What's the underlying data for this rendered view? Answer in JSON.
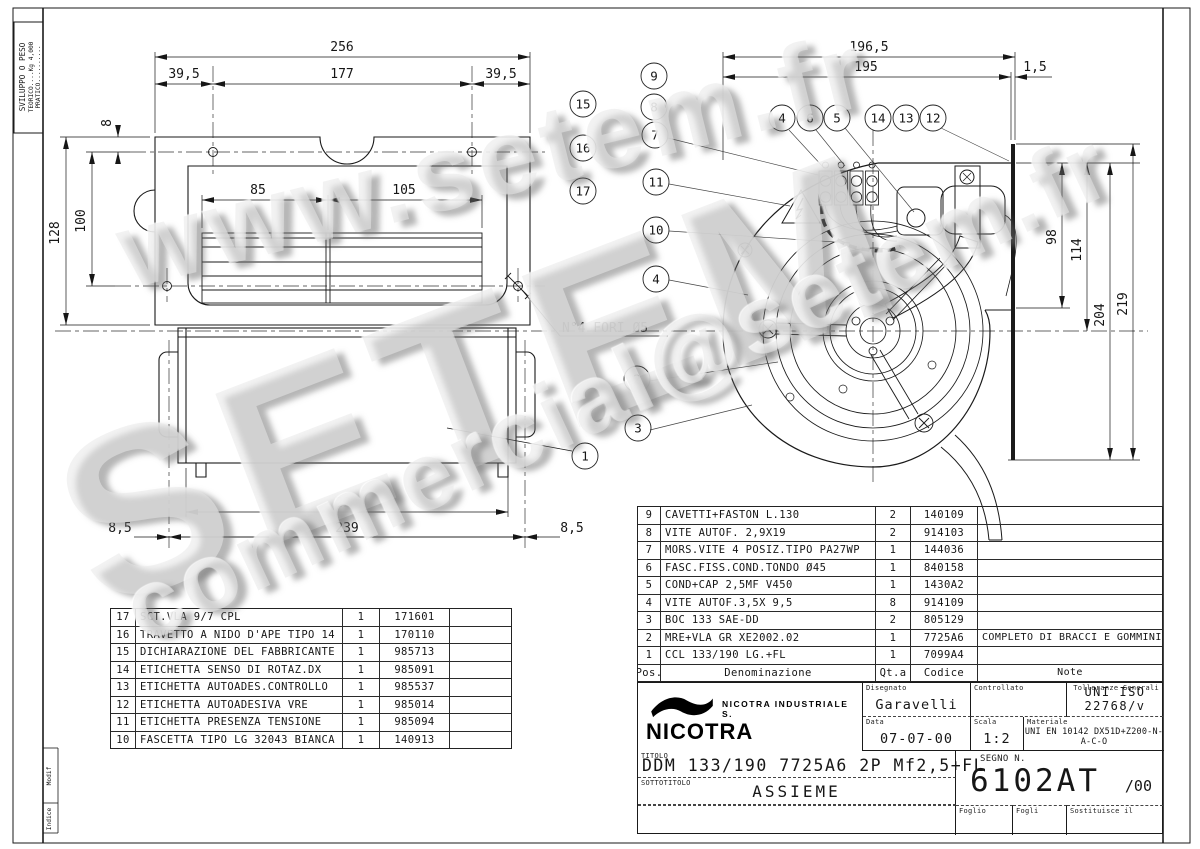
{
  "watermarks": {
    "line1": "www.setem.fr",
    "line2": "SETEM",
    "line3": "commercial@setem.fr"
  },
  "margins": {
    "weight_box": {
      "title": "SVILUPPO O PESO",
      "teorico": "TEORICO....Kg 4,000",
      "pratico": "PRATICO.........."
    },
    "rev_modif": "Modif",
    "rev_indice": "Indice"
  },
  "top_view": {
    "dim_256": "256",
    "dim_39_5_l": "39,5",
    "dim_177": "177",
    "dim_39_5_r": "39,5",
    "dim_8": "8",
    "dim_128": "128",
    "dim_100": "100",
    "dim_85": "85",
    "dim_105": "105",
    "note_holes": "N°4 FORI Ø5"
  },
  "front_view": {
    "dim_224": "224",
    "dim_239": "239",
    "dim_8_5_l": "8,5",
    "dim_8_5_r": "8,5",
    "balloon_1": "1"
  },
  "fan_view": {
    "dim_196_5": "196,5",
    "dim_195": "195",
    "dim_1_5": "1,5",
    "dim_98": "98",
    "dim_114": "114",
    "dim_204": "204",
    "dim_219": "219"
  },
  "balloons": {
    "stack": [
      "15",
      "16",
      "17"
    ],
    "fan_left": [
      "9",
      "8",
      "7",
      "11",
      "10",
      "4",
      "2",
      "3"
    ],
    "fan_top": [
      "4",
      "6",
      "5",
      "14",
      "13",
      "12"
    ]
  },
  "parts_left": {
    "rows": [
      {
        "pos": "17",
        "desc": "SCT.VLA 9/7 CPL",
        "qty": "1",
        "code": "171601"
      },
      {
        "pos": "16",
        "desc": "TRAVETTO A NIDO D'APE TIPO 14",
        "qty": "1",
        "code": "170110"
      },
      {
        "pos": "15",
        "desc": "DICHIARAZIONE DEL FABBRICANTE",
        "qty": "1",
        "code": "985713"
      },
      {
        "pos": "14",
        "desc": "ETICHETTA SENSO DI ROTAZ.DX",
        "qty": "1",
        "code": "985091"
      },
      {
        "pos": "13",
        "desc": "ETICHETTA AUTOADES.CONTROLLO",
        "qty": "1",
        "code": "985537"
      },
      {
        "pos": "12",
        "desc": "ETICHETTA AUTOADESIVA VRE",
        "qty": "1",
        "code": "985014"
      },
      {
        "pos": "11",
        "desc": "ETICHETTA PRESENZA TENSIONE",
        "qty": "1",
        "code": "985094"
      },
      {
        "pos": "10",
        "desc": "FASCETTA TIPO LG 32043 BIANCA",
        "qty": "1",
        "code": "140913"
      }
    ]
  },
  "parts_right": {
    "header": {
      "pos": "Pos.",
      "desc": "Denominazione",
      "qty": "Qt.a",
      "code": "Codice",
      "note": "Note"
    },
    "rows": [
      {
        "pos": "9",
        "desc": "CAVETTI+FASTON L.130",
        "qty": "2",
        "code": "140109",
        "note": ""
      },
      {
        "pos": "8",
        "desc": "VITE AUTOF. 2,9X19",
        "qty": "2",
        "code": "914103",
        "note": ""
      },
      {
        "pos": "7",
        "desc": "MORS.VITE 4 POSIZ.TIPO PA27WP",
        "qty": "1",
        "code": "144036",
        "note": ""
      },
      {
        "pos": "6",
        "desc": "FASC.FISS.COND.TONDO Ø45",
        "qty": "1",
        "code": "840158",
        "note": ""
      },
      {
        "pos": "5",
        "desc": "COND+CAP 2,5MF V450",
        "qty": "1",
        "code": "1430A2",
        "note": ""
      },
      {
        "pos": "4",
        "desc": "VITE AUTOF.3,5X 9,5",
        "qty": "8",
        "code": "914109",
        "note": ""
      },
      {
        "pos": "3",
        "desc": "BOC 133 SAE-DD",
        "qty": "2",
        "code": "805129",
        "note": ""
      },
      {
        "pos": "2",
        "desc": "MRE+VLA GR XE2002.02",
        "qty": "1",
        "code": "7725A6",
        "note": "COMPLETO DI BRACCI E GOMMINI"
      },
      {
        "pos": "1",
        "desc": "CCL 133/190 LG.+FL",
        "qty": "1",
        "code": "7099A4",
        "note": ""
      }
    ]
  },
  "title_block": {
    "logo": "NICOTRA",
    "company": "NICOTRA INDUSTRIALE S.",
    "lbl_disegnato": "Disegnato",
    "disegnato": "Garavelli",
    "lbl_controllato": "Controllato",
    "controllato": "",
    "lbl_tolleranze": "Tolleranze Generali",
    "tolleranze": "UNI ISO 22768/v",
    "lbl_data": "Data",
    "data": "07-07-00",
    "lbl_scala": "Scala",
    "scala": "1:2",
    "lbl_materiale": "Materiale",
    "materiale": "UNI EN 10142 DX51D+Z200-N-A-C-O",
    "lbl_titolo": "TITOLO",
    "titolo": "DDM 133/190 7725A6 2P Mf2,5+FL",
    "lbl_sottotitolo": "SOTTOTITOLO",
    "sottotitolo": "ASSIEME",
    "lbl_segno": "SEGNO N.",
    "segno": "6102AT",
    "segno_rev": "/00",
    "lbl_foglio": "Foglio",
    "lbl_fogli": "Fogli",
    "lbl_sostituisce": "Sostituisce il"
  }
}
